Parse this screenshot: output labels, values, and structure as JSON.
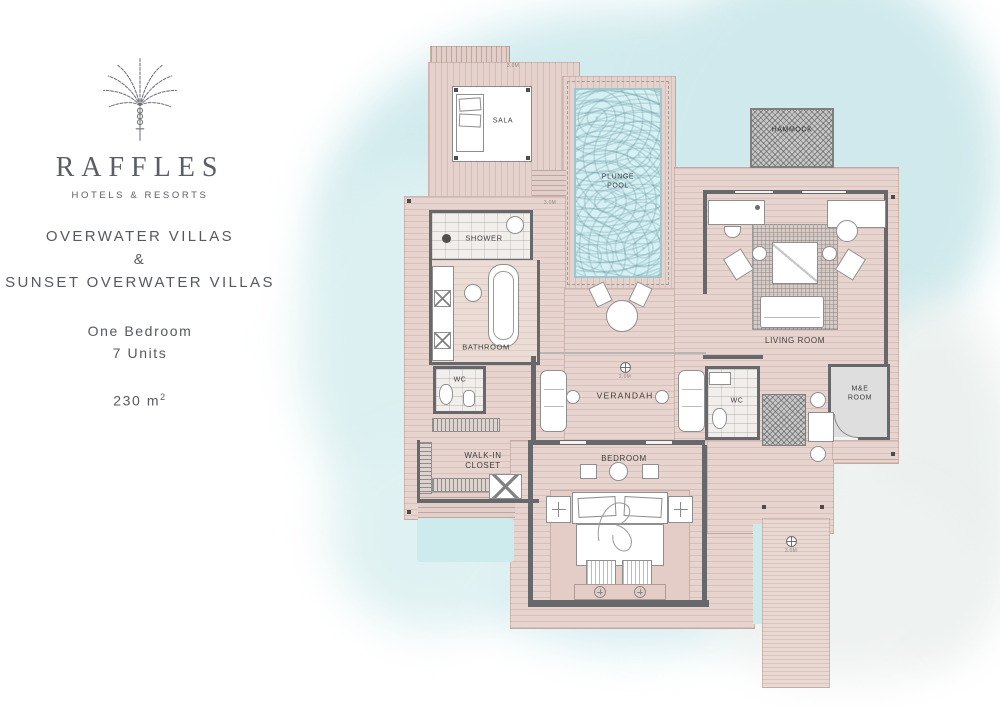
{
  "brand": {
    "name": "RAFFLES",
    "tagline": "HOTELS & RESORTS"
  },
  "panel": {
    "title_line1": "OVERWATER VILLAS",
    "title_amp": "&",
    "title_line2": "SUNSET OVERWATER VILLAS",
    "subtitle_line1": "One Bedroom",
    "subtitle_line2": "7 Units",
    "area_value": "230 m",
    "area_sup": "2"
  },
  "floorplan": {
    "rooms": {
      "sala": "SALA",
      "plunge_pool": "PLUNGE\nPOOL",
      "hammock": "HAMMOCK",
      "shower": "SHOWER",
      "bathroom": "BATHROOM",
      "wc_master": "WC",
      "walk_in_closet": "WALK-IN\nCLOSET",
      "verandah": "VERANDAH",
      "bedroom": "BEDROOM",
      "living_room": "LIVING ROOM",
      "wc_guest": "WC",
      "me_room": "M&E\nROOM"
    },
    "level_markers": {
      "sala_steps": "3.0M",
      "pool_deck": "3.0M",
      "verandah": "2.0M",
      "jetty": "3.0M"
    },
    "colors": {
      "water": "#d7edf0",
      "deck": "#e7d4ce",
      "wall": "#67686c",
      "pool_water": "#d6f0f3",
      "hammock": "#c6c6c6"
    }
  }
}
